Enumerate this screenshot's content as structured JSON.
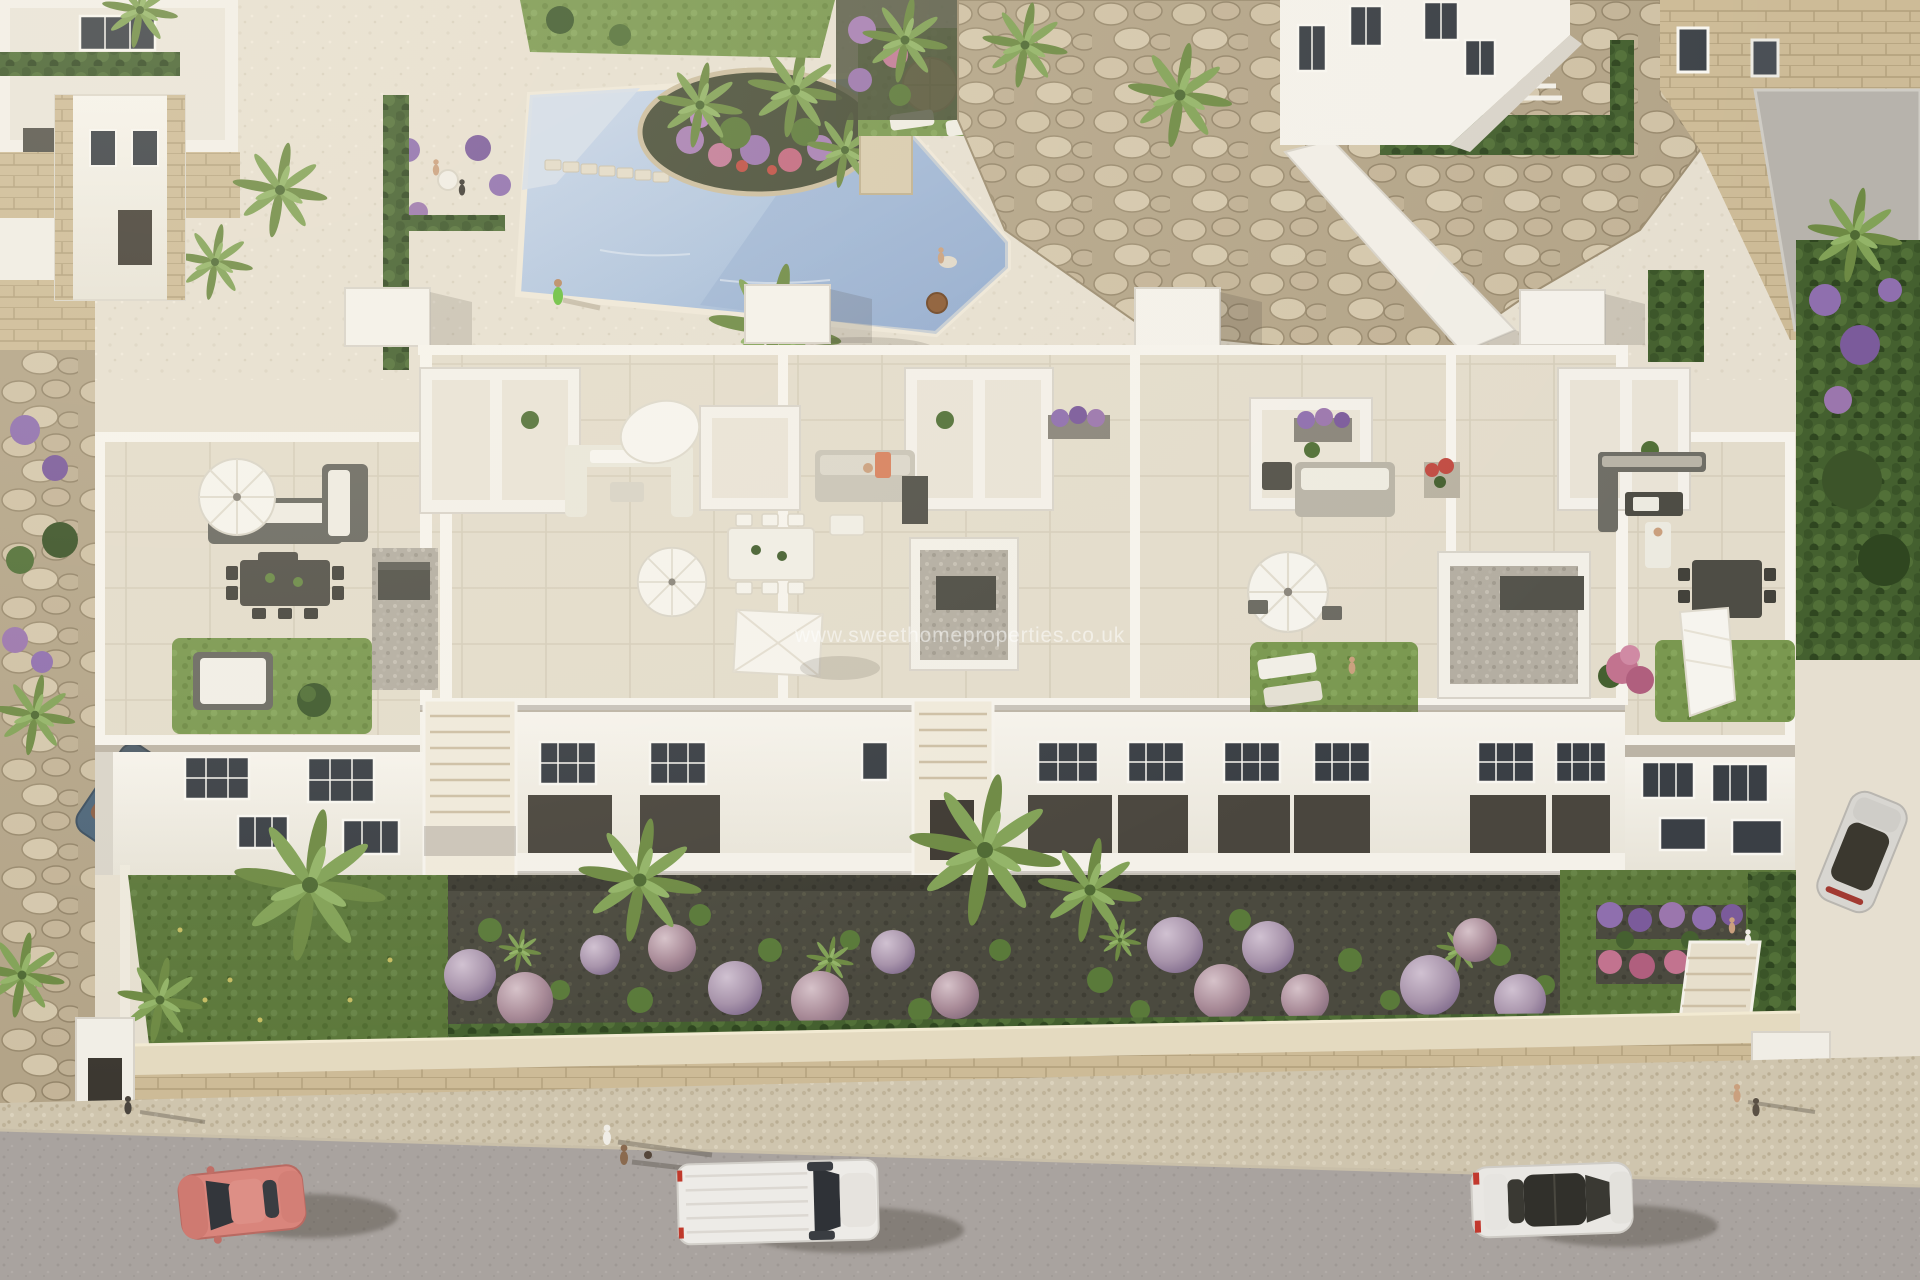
{
  "image": {
    "kind": "aerial-architectural-render",
    "subject": "bird's-eye 3D render of a white apartment complex with rooftop terraces, communal pool, gardens and street"
  },
  "watermark": {
    "text": "www.sweethomeproperties.co.uk"
  },
  "palette": {
    "pool_water": "#a9bdd9",
    "deck_plaza": "#e6dfd0",
    "building_white": "#f4f1ea",
    "roof_tile": "#e3dccb",
    "rooftop_lawn": "#7a9850",
    "garden_lawn": "#5c783b",
    "soil_bed": "#4b4a3f",
    "lavender_shrub": "#a894ab",
    "boulder_wall": "#b7a88c",
    "masonry_wall": "#cdbb97",
    "sidewalk": "#cfc5ae",
    "asphalt": "#a9a39f",
    "hedge_green": "#44602f",
    "furniture_grey": "#55534b",
    "car_salmon": "#d9857c",
    "car_white_van": "#edebe7",
    "car_white_sedan": "#e9e7e3",
    "car_blue_convertible": "#4d6579",
    "car_silver": "#d8d6d1"
  },
  "scene": {
    "regions": [
      "pool-terrace",
      "rock-boulder-wall",
      "neighbour-villas",
      "rooftop-terraces",
      "building-facade",
      "front-garden",
      "boundary-wall",
      "street"
    ],
    "vehicles": [
      "salmon-coupe",
      "white-van",
      "white-sedan",
      "blue-convertible",
      "silver-car"
    ],
    "props": [
      "white-parasols",
      "square-shade-sail",
      "outdoor-sofas",
      "dining-sets",
      "sun-loungers",
      "ac-units",
      "lavender-shrubs",
      "palm-trees",
      "stepping-stones",
      "pedestrians"
    ]
  }
}
